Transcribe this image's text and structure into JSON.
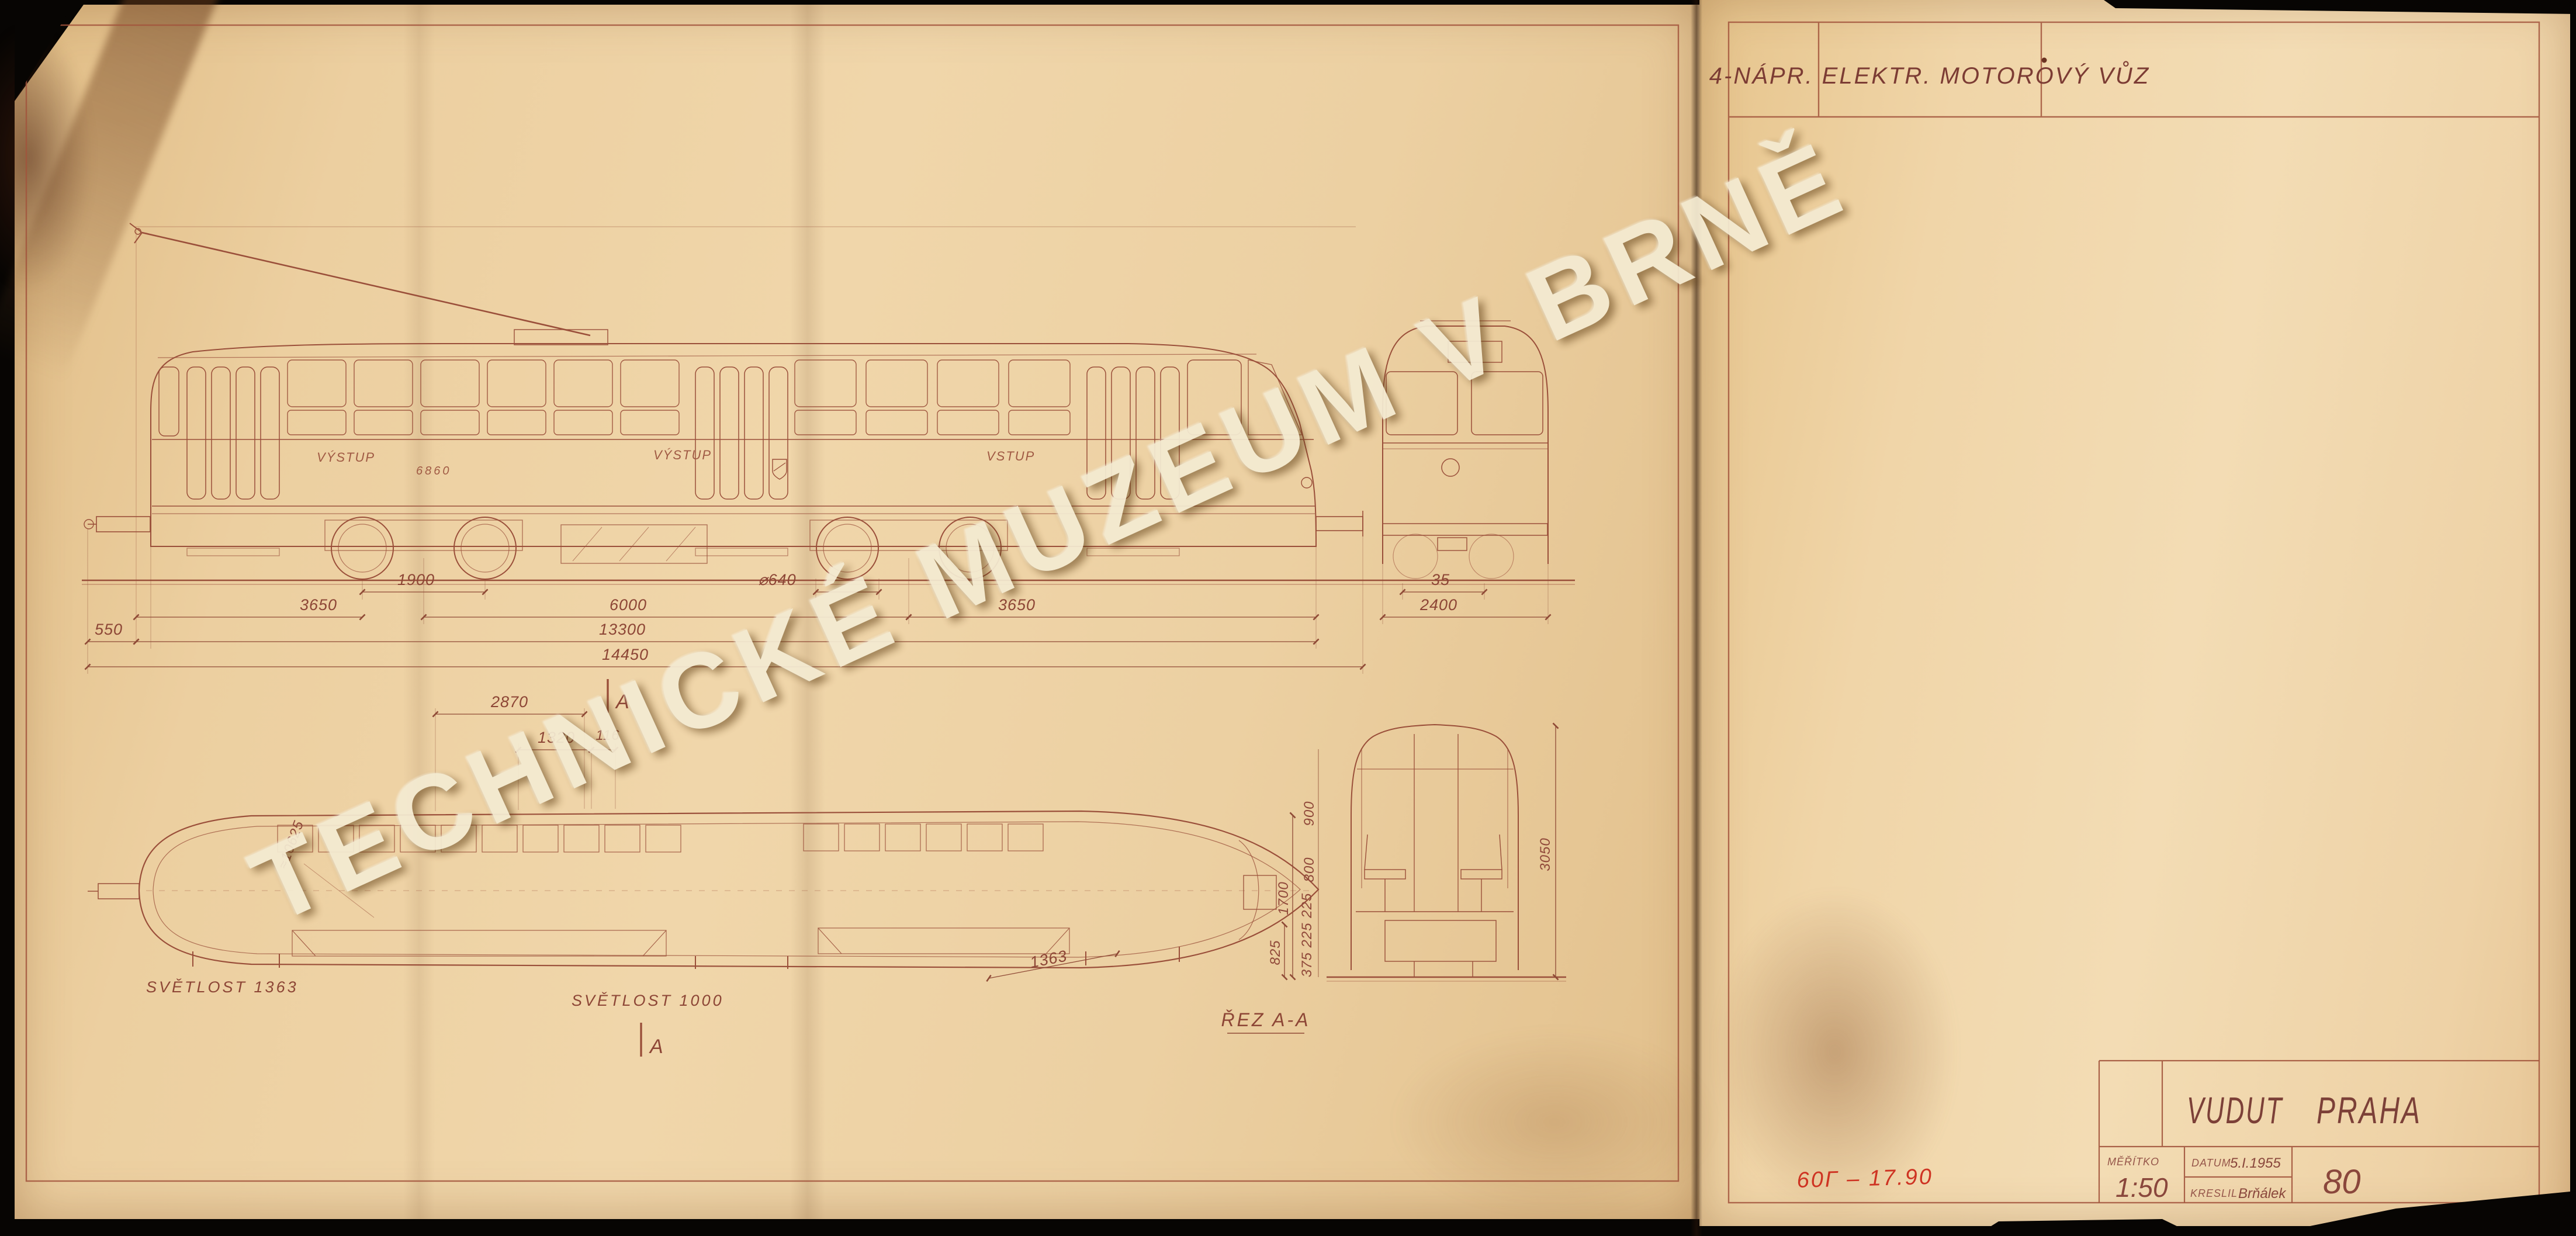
{
  "watermark": {
    "text": "TECHNICKÉ MUZEUM V BRNĚ"
  },
  "header": {
    "title": "4-NÁPR. ELEKTR. MOTOROVÝ VŮZ"
  },
  "title_block": {
    "org": "VUDUT",
    "city": "PRAHA",
    "scale_label": "MĚŘÍTKO",
    "scale_value": "1:50",
    "date_label": "DATUM",
    "date_value": "5.I.1955",
    "drawn_label": "KRESLIL",
    "drawn_value": "Brňálek",
    "drawing_number": "80"
  },
  "annotations": {
    "red_note": "60Г – 17.90"
  },
  "side_view": {
    "door_label_rear": "VÝSTUP",
    "door_label_middle": "VÝSTUP",
    "door_label_front": "VSTUP",
    "car_number": "6860",
    "dims": {
      "rear_coupler_550": "550",
      "rear_overhang_3650": "3650",
      "bogie_wheelbase_1900": "1900",
      "bogie_centers_6000": "6000",
      "body_length_13300": "13300",
      "total_length_14450": "14450",
      "wheel_dia_640": "⌀640",
      "front_overhang_3650": "3650"
    }
  },
  "end_view": {
    "dims": {
      "d35": "35",
      "width_2400": "2400"
    }
  },
  "floor_plan": {
    "label_rear_door": "SVĚTLOST 1363",
    "label_mid_door": "SVĚTLOST 1000",
    "dim_front_door": "1363",
    "radius_note": "≈10625",
    "dims": {
      "d2870": "2870",
      "d1320": "1320",
      "d116": "116"
    },
    "section_marker": "A"
  },
  "cross_section": {
    "caption": "ŘEZ A-A",
    "dims": {
      "d825": "825",
      "d_stack": "375 225 225",
      "d800": "800",
      "d900": "900",
      "d1700": "1700",
      "height_3050": "3050"
    }
  }
}
